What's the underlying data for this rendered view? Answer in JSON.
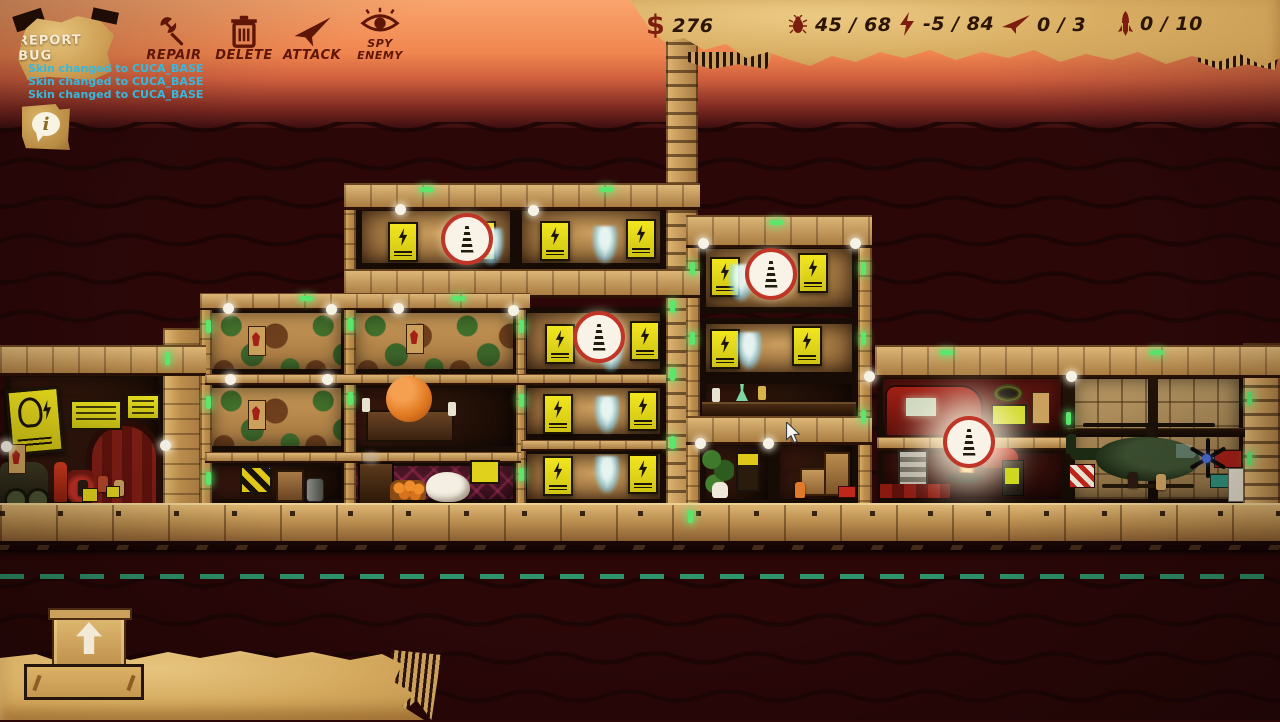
{
  "colors": {
    "background": "#2b0708",
    "cardboard_light": "#e2bb72",
    "cardboard_dark": "#a87a42",
    "frame": "#170c05",
    "sign_yellow": "#ecdf1b",
    "badge_ring": "#bf3527",
    "node_white": "#f7f2e6",
    "light_green": "#5ce66e",
    "dash_teal": "#2e9b73",
    "hud_text": "#2b1504",
    "icon_maroon": "#7c1d0f",
    "label_maroon": "#5f1606",
    "message_cyan": "#38b8dc",
    "button_text_cream": "#f7ecd2",
    "sky_top": "#f9a56d",
    "sky_bottom": "#3c0e0f"
  },
  "hud": {
    "report_bug": {
      "label": "REPORT BUG"
    },
    "console_messages": [
      "Skin changed to CUCA_BASE",
      "Skin changed to CUCA_BASE",
      "Skin changed to CUCA_BASE"
    ],
    "info_button": {
      "glyph": "i"
    },
    "resources": {
      "money": {
        "icon": "dollar-icon",
        "symbol": "$",
        "value": "276"
      },
      "population": {
        "icon": "bug-icon",
        "value": "45 / 68"
      },
      "power": {
        "icon": "lightning-icon",
        "value": "-5 / 84"
      },
      "planes": {
        "icon": "paper-plane-icon",
        "value": "0 / 3"
      },
      "rockets": {
        "icon": "rocket-icon",
        "value": "0 / 10"
      }
    },
    "toolbar": {
      "repair": {
        "icon": "wrench-icon",
        "label": "REPAIR"
      },
      "delete": {
        "icon": "trash-icon",
        "label": "DELETE"
      },
      "attack": {
        "icon": "paper-plane-icon",
        "label": "ATTACK"
      },
      "spy": {
        "icon": "eye-icon",
        "line1": "SPY",
        "line2": "ENEMY"
      }
    }
  }
}
